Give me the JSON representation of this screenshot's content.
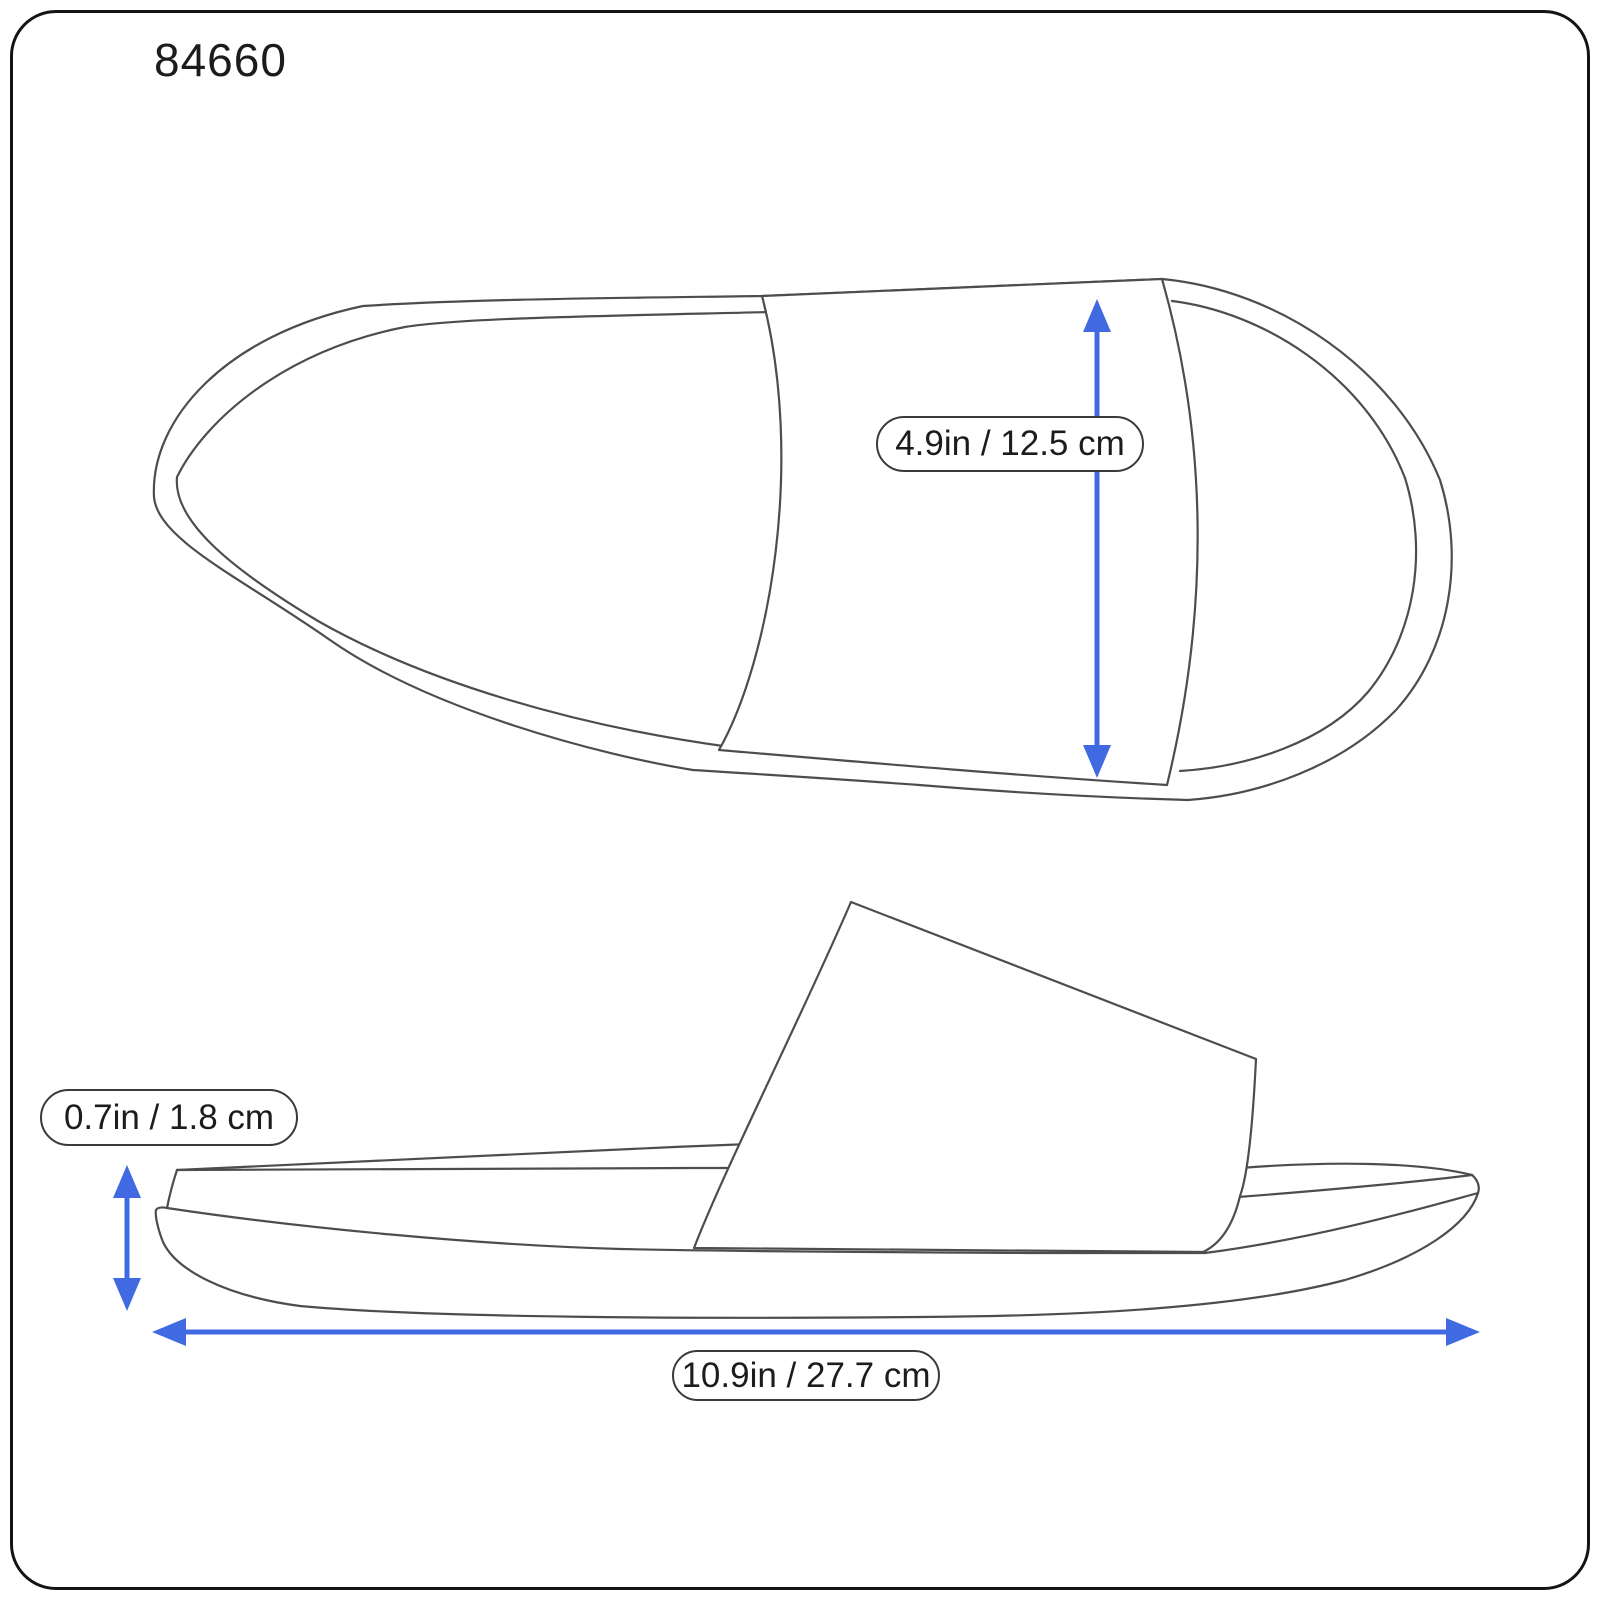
{
  "product": {
    "code": "84660"
  },
  "measurements": {
    "strap_width": "4.9in / 12.5 cm",
    "sole_height": "0.7in / 1.8 cm",
    "length": "10.9in / 27.7 cm"
  },
  "views": {
    "top_view": "slide sandal seen from above, toe left, heel right, wide strap band across right-center",
    "side_view": "slide sandal profile, toe left, heel right, slanted strap wedge over contoured sole"
  },
  "icons": {
    "strap_width_arrow": "vertical-double-arrow-icon",
    "sole_height_arrow": "vertical-double-arrow-icon",
    "length_arrow": "horizontal-double-arrow-icon"
  },
  "colors": {
    "arrow": "#4169E1",
    "line": "#4d4d4d",
    "frame": "#141414",
    "pill_border": "#3a3a3a",
    "text": "#1c1c1c",
    "background": "#ffffff"
  }
}
